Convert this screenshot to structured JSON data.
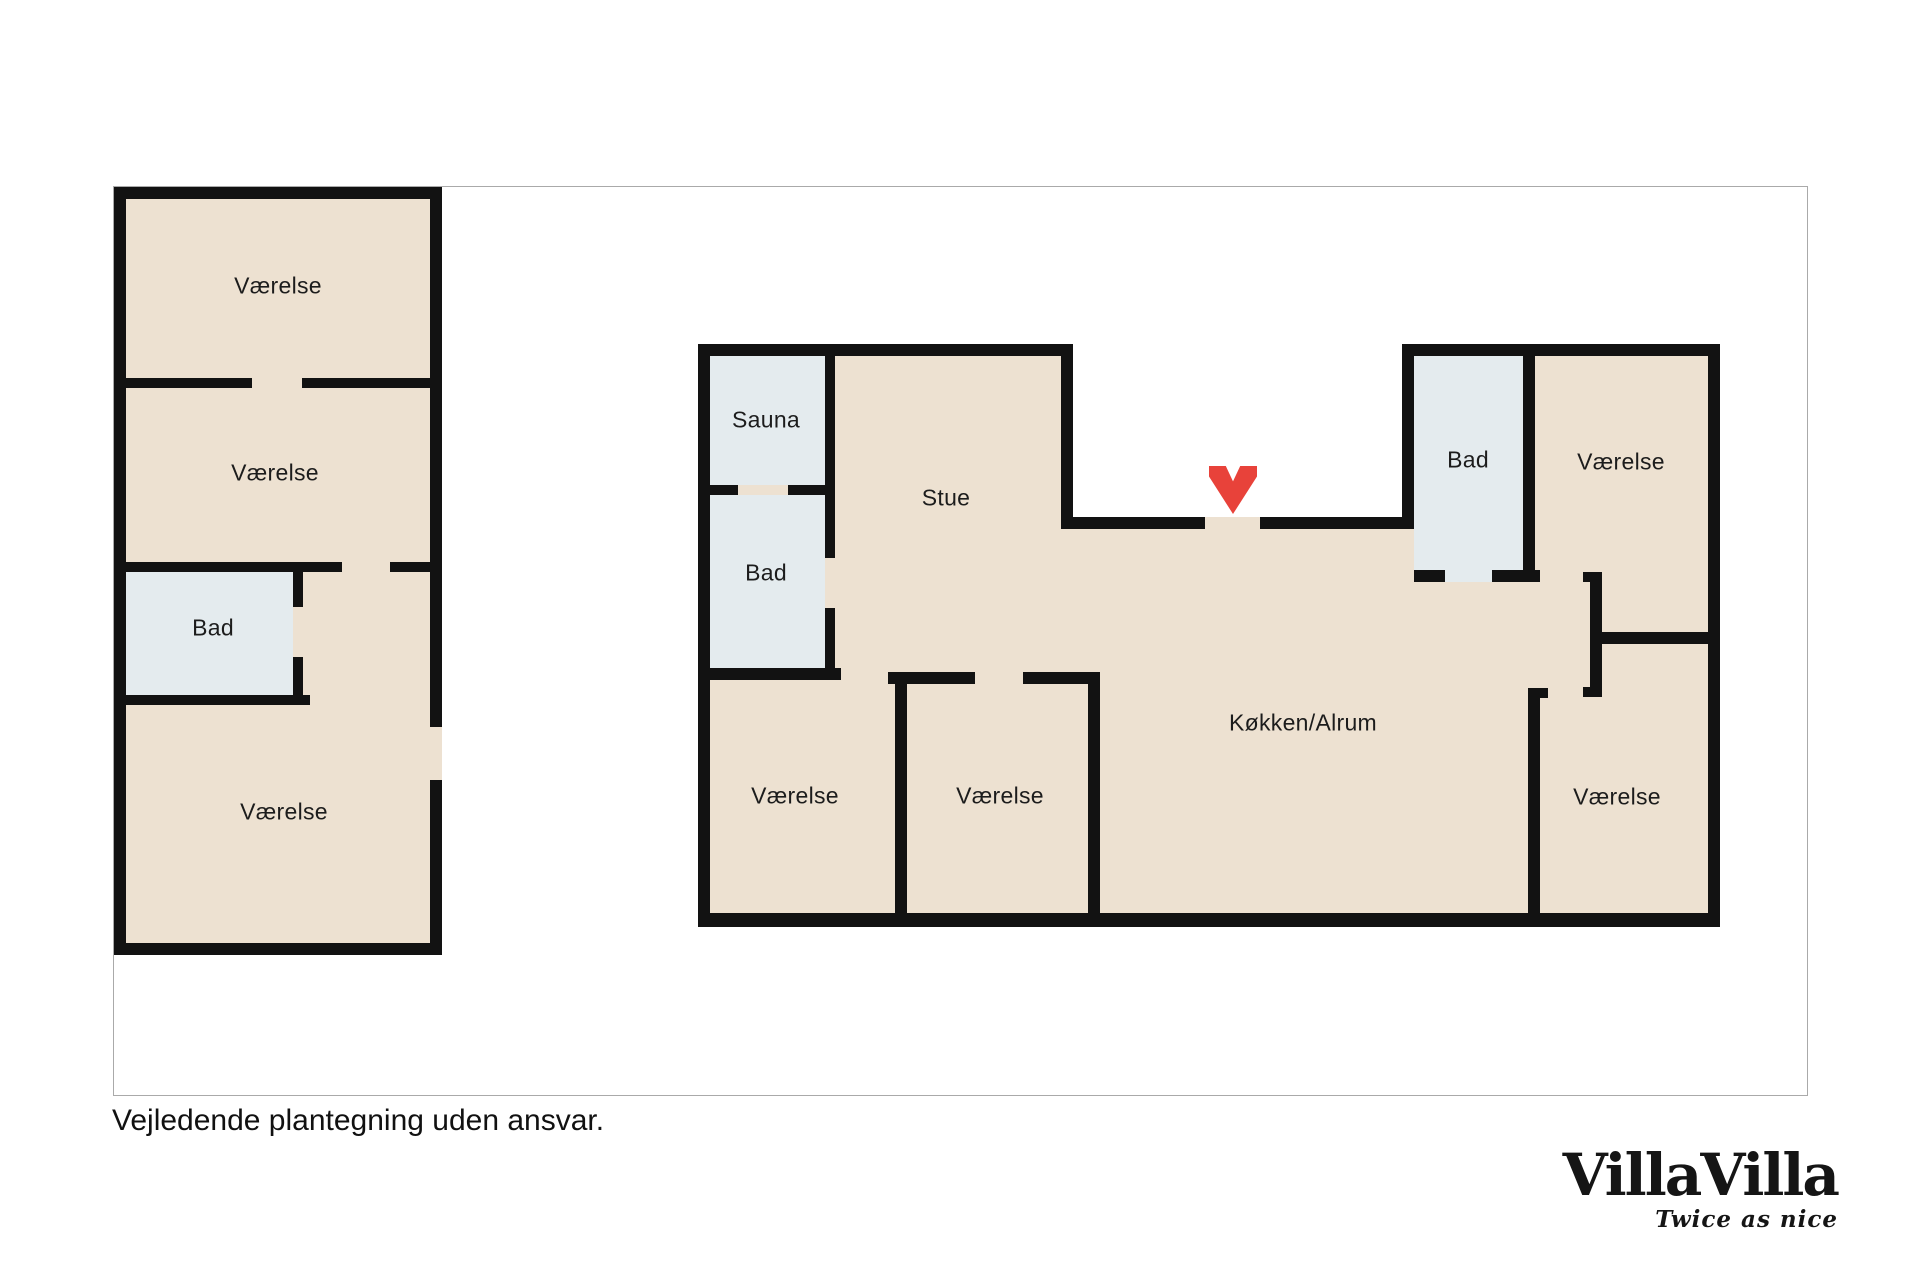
{
  "plan_type": "floorplan",
  "caption": "Vejledende plantegning uden ansvar.",
  "logo": {
    "title": "VillaVilla",
    "tagline": "Twice as nice"
  },
  "colors": {
    "floor": "#ede1d1",
    "wet_room": "#e4ebee",
    "wall": "#121212",
    "arrow": "#e8423a",
    "frame": "#aaaaaa"
  },
  "entrance_marker": "chevron-down-red",
  "buildings": [
    {
      "name": "annex",
      "rooms": [
        {
          "label": "Værelse"
        },
        {
          "label": "Værelse"
        },
        {
          "label": "Bad"
        },
        {
          "label": "Værelse"
        }
      ]
    },
    {
      "name": "main-house",
      "rooms": [
        {
          "label": "Sauna"
        },
        {
          "label": "Bad"
        },
        {
          "label": "Stue"
        },
        {
          "label": "Bad"
        },
        {
          "label": "Værelse"
        },
        {
          "label": "Værelse"
        },
        {
          "label": "Værelse"
        },
        {
          "label": "Køkken/Alrum"
        },
        {
          "label": "Værelse"
        }
      ]
    }
  ]
}
